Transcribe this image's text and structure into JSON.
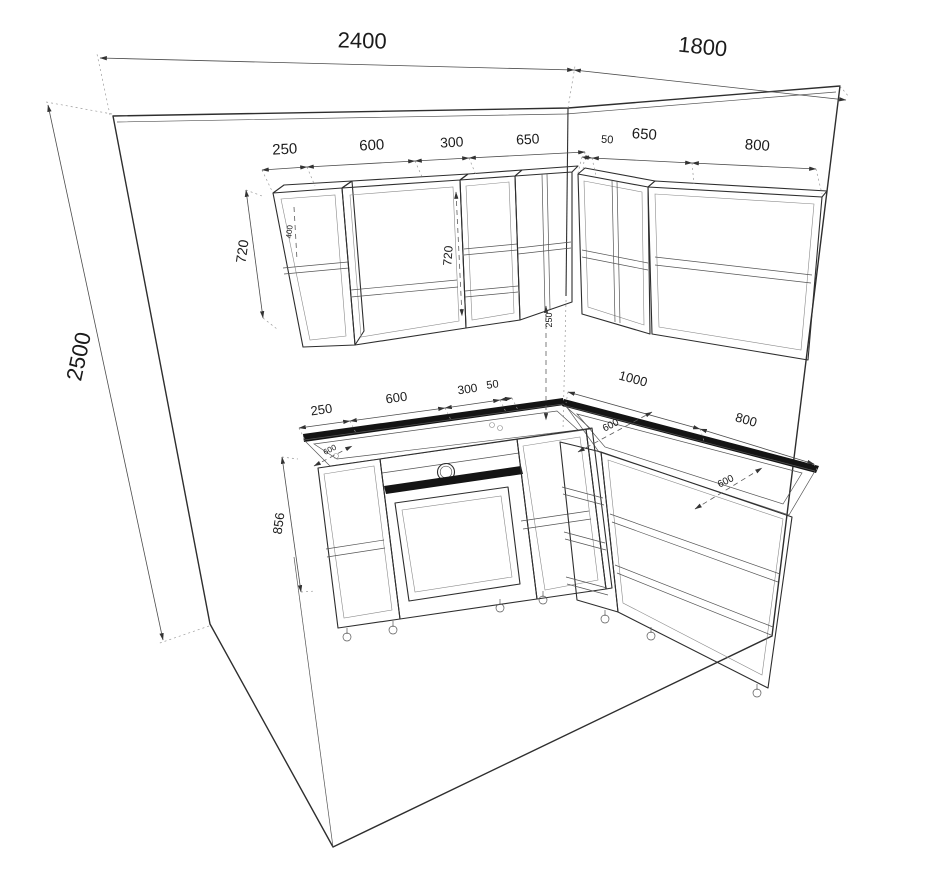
{
  "drawing_type": "kitchen-cabinet-technical-drawing",
  "dims": {
    "room": {
      "left_wall_width": "2400",
      "right_wall_width": "1800",
      "wall_height": "2500"
    },
    "wall_cabinets": {
      "left_row": [
        "250",
        "600",
        "300",
        "650"
      ],
      "right_row": [
        "50",
        "650",
        "800"
      ],
      "row_height": "720",
      "cabinet_inner_height": "720",
      "upper_shelf_drop": "400",
      "backsplash_gap": "250"
    },
    "base_cabinets": {
      "left_row": [
        "250",
        "600",
        "300",
        "50"
      ],
      "right_row": [
        "1000",
        "800"
      ],
      "row_height": "856",
      "counter_depth_left": "600",
      "counter_depth_corner": "600",
      "counter_depth_right": "600"
    }
  }
}
